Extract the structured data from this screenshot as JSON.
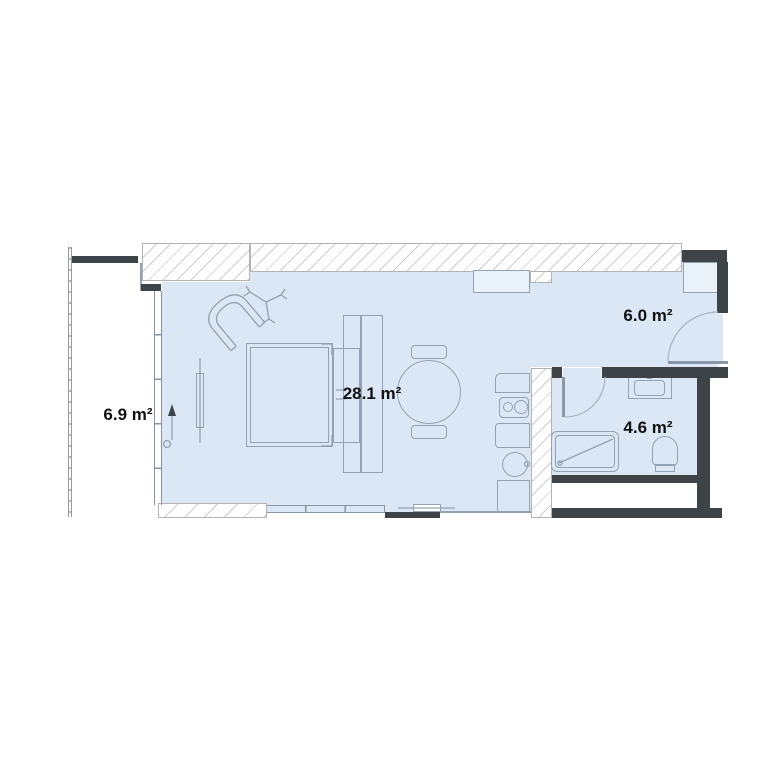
{
  "plan": {
    "rooms": [
      {
        "id": "balcony",
        "area": "6.9 m²"
      },
      {
        "id": "living-room",
        "area": "28.1 m²"
      },
      {
        "id": "hallway",
        "area": "6.0 m²"
      },
      {
        "id": "bathroom",
        "area": "4.6 m²"
      }
    ],
    "colors": {
      "floor_fill": "#dbe7f4",
      "wall_dark": "#3e4347",
      "furniture_line": "#93a1b5",
      "hatch_line": "#cdcdcd",
      "label_text": "#111111"
    }
  }
}
